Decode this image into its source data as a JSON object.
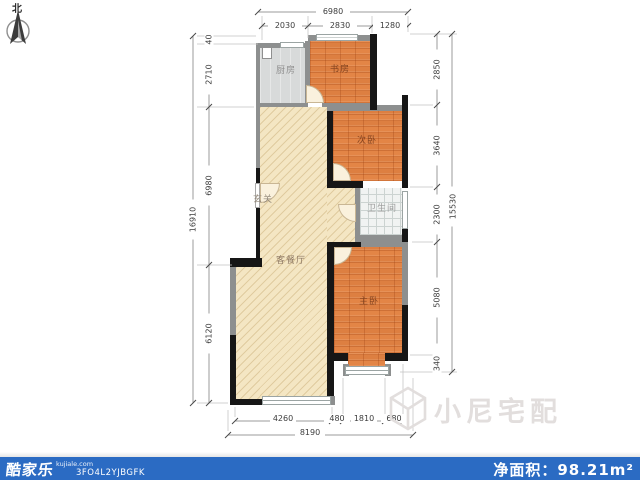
{
  "north": {
    "label": "北"
  },
  "plan": {
    "rooms": {
      "kitchen": "厨房",
      "study": "书房",
      "bedroom2": "次卧",
      "bathroom": "卫生间",
      "entry": "玄关",
      "living": "客餐厅",
      "master": "主卧"
    }
  },
  "dimensions": {
    "top": {
      "segments": [
        "2030",
        "2830",
        "1280"
      ],
      "total": "6980"
    },
    "left": {
      "segments": [
        "40",
        "2710",
        "6980",
        "6120"
      ],
      "total": "16910"
    },
    "right": {
      "segments": [
        "2850",
        "3640",
        "2300",
        "5080",
        "340"
      ],
      "total": "15530"
    },
    "bottom": {
      "segments": [
        "4260",
        "480",
        "1810",
        "680"
      ],
      "total": "8190"
    }
  },
  "watermark": {
    "text": "小尼宅配"
  },
  "footer": {
    "brand": "酷家乐",
    "domain": "kujiale.com",
    "code": "3FO4L2YJBGFK",
    "area": "净面积：98.21m²"
  },
  "colors": {
    "accent_blue": "#2b6bc3",
    "wood_floor": "#dd7f41",
    "living_floor": "#f4e6c3",
    "wall_dark": "#161616",
    "wall_gray": "#8d8f8f"
  }
}
